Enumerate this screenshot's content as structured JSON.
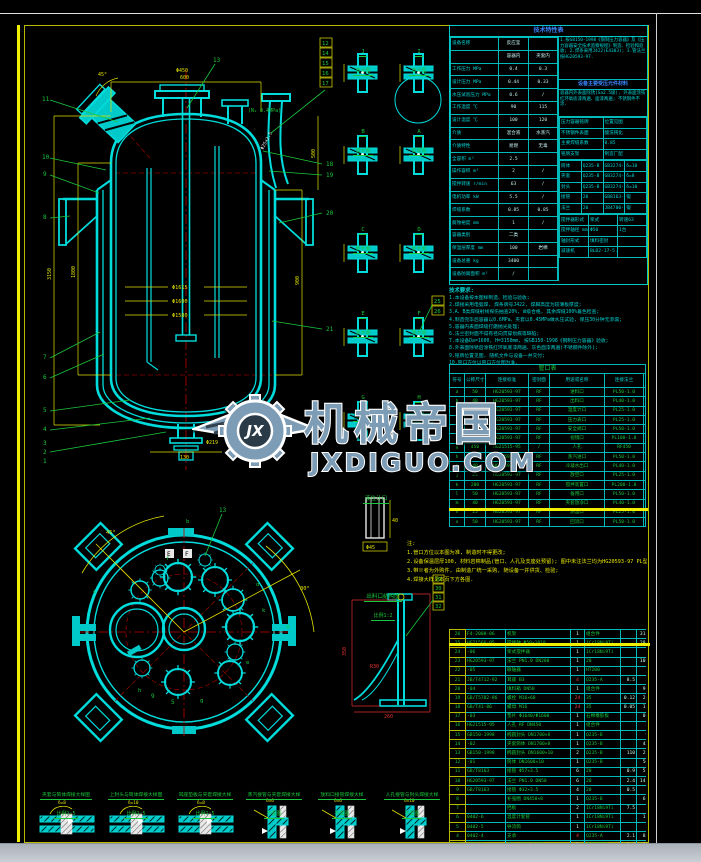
{
  "watermark": {
    "brand": "机械帝国",
    "site": "JXDIGUO.COM",
    "logo_text": "JX"
  },
  "spec_table": {
    "title": "技术特性表",
    "left_rows": [
      [
        "设备名称",
        "反应釜",
        ""
      ],
      [
        "",
        "容器内",
        "夹套内"
      ],
      [
        "工作压力 MPa",
        "0.4",
        "0.3"
      ],
      [
        "设计压力 MPa",
        "0.44",
        "0.33"
      ],
      [
        "水压试验压力 MPa",
        "0.6",
        "/"
      ],
      [
        "工作温度 ℃",
        "90",
        "115"
      ],
      [
        "设计温度 ℃",
        "100",
        "120"
      ],
      [
        "介质",
        "混合液",
        "水蒸汽"
      ],
      [
        "介质特性",
        "易燃",
        "无毒"
      ],
      [
        "全容积 m³",
        "2.5",
        ""
      ],
      [
        "操作容积 m³",
        "2",
        "/"
      ],
      [
        "搅拌转速 r/min",
        "63",
        "/"
      ],
      [
        "电机功率 kW",
        "5.5",
        "/"
      ],
      [
        "焊缝系数",
        "0.85",
        "0.85"
      ],
      [
        "腐蚀裕度 mm",
        "1",
        "/"
      ],
      [
        "容器类别",
        "二类",
        ""
      ],
      [
        "保温层厚度 mm",
        "100",
        "岩棉"
      ],
      [
        "设备总重 kg",
        "3400",
        ""
      ],
      [
        "设备防腐面积 m²",
        "/",
        ""
      ]
    ],
    "right": {
      "standards": "1.按GB150-1998《钢制压力容器》及《压力容器安全技术监察规程》制造、检验和验收; 2.焊条采用J422(E4303); 3.管法兰按HG20593-97.",
      "materials_header": "设备主要受压元件材料",
      "surface": "容器内外表面除锈(Sa2.5级), 外表面涂铁红环氧底漆两遍、面漆两遍; 不锈钢件不涂.",
      "plate_rows": [
        [
          "压力容器铭牌",
          "位置见图"
        ],
        [
          "不锈钢件表面",
          "酸洗钝化"
        ],
        [
          "主要焊缝系数",
          "0.85"
        ],
        [
          "铭牌支架",
          "制造厂配"
        ]
      ],
      "material_rows": [
        [
          "筒体",
          "Q235-B",
          "GB3274-88",
          "δ=10"
        ],
        [
          "夹套",
          "Q235-B",
          "GB3274-88",
          "δ=8"
        ],
        [
          "封头",
          "Q235-B",
          "GB3274-88",
          "δ=10"
        ],
        [
          "接管",
          "20",
          "GB8163-87",
          "锻"
        ],
        [
          "法兰",
          "20",
          "JB4700-92",
          "锻"
        ]
      ],
      "drive_rows": [
        [
          "搅拌器形式",
          "桨式",
          "转速63"
        ],
        [
          "搅拌轴径 mm",
          "Φ50",
          "1台"
        ],
        [
          "轴封形式",
          "填料密封",
          ""
        ],
        [
          "减速机",
          "BLD2-17-5.5",
          ""
        ]
      ]
    }
  },
  "tech_notes": {
    "title": "技术要求:",
    "lines": [
      [
        "1.本设备按本图样制造、检验与验收;"
      ],
      [
        "2.焊接采用电弧焊, 焊条牌号J422, 焊脚高度为较薄板厚度;"
      ],
      [
        "3.A、B类焊缝射线探伤抽查20%, Ⅲ级合格, 其余焊缝100%着色检查;"
      ],
      [
        "4.制造完毕后容器以0.6MPa、夹套以0.45MPa做水压试验, 保压30分钟无渗漏;"
      ],
      [
        "5.容器内表面焊缝打磨抛光处理;"
      ],
      [
        "6.法兰密封面不得有径向贯穿划痕等缺陷;"
      ],
      [
        "7.本设备Da=1600, H=3150mm, 按GB150-1998《钢制压力容器》验收;"
      ],
      [
        "8.外表面除锈后涂铁红环氧底漆两遍、灰色面漆两遍(不锈钢件除外);"
      ],
      [
        "9.铭牌位置见图, 随机文件与设备一并交付;"
      ],
      [
        "10.管口方位以管口方位图为准."
      ]
    ]
  },
  "nozzle_table": {
    "title": "管口表",
    "headers": [
      "符号",
      "公称尺寸",
      "连接标准",
      "密封面",
      "用途或名称",
      "连接法兰",
      "备注"
    ],
    "rows": [
      [
        "a",
        "50",
        "HG20593-97",
        "RF",
        "进料口",
        "PL50-1.0",
        "/"
      ],
      [
        "b",
        "40",
        "HG20593-97",
        "RF",
        "出料口",
        "PL40-1.0",
        ""
      ],
      [
        "c",
        "25",
        "HG20593-97",
        "RF",
        "温度计口",
        "PL25-1.0",
        ""
      ],
      [
        "d",
        "25",
        "HG20593-97",
        "RF",
        "压力表口",
        "PL25-1.0",
        ""
      ],
      [
        "e",
        "50",
        "HG20593-97",
        "RF",
        "安全阀口",
        "PL50-1.0",
        ""
      ],
      [
        "f",
        "100",
        "HG20593-97",
        "RF",
        "视镜口",
        "PL100-1.0",
        ""
      ],
      [
        "g",
        "450",
        "HG21515-95",
        "/",
        "人孔",
        "RF450",
        ""
      ],
      [
        "h",
        "50",
        "HG20593-97",
        "RF",
        "蒸汽进口",
        "PL50-1.0",
        ""
      ],
      [
        "i",
        "40",
        "HG20593-97",
        "RF",
        "冷凝水出口",
        "PL40-1.0",
        ""
      ],
      [
        "j",
        "25",
        "HG20593-97",
        "RF",
        "放空口",
        "PL25-1.0",
        ""
      ],
      [
        "k",
        "200",
        "HG20593-97",
        "RF",
        "搅拌装置口",
        "PL200-1.0",
        ""
      ],
      [
        "l",
        "50",
        "HG20593-97",
        "RF",
        "备用口",
        "PL50-1.0",
        ""
      ],
      [
        "m",
        "40",
        "HG20593-97",
        "RF",
        "夹套放净口",
        "PL40-1.0",
        ""
      ],
      [
        "n",
        "25",
        "HG20593-97",
        "RF",
        "测温口",
        "PL25-1.0",
        ""
      ],
      [
        "o",
        "50",
        "HG20593-97",
        "RF",
        "回流口",
        "PL50-1.0",
        ""
      ]
    ]
  },
  "side_note": {
    "lines": [
      [
        "注:"
      ],
      [
        "1.管口方位以本图为准, 制造时不得更改;"
      ],
      [
        "2.设备保温层厚100, 材料岩棉制品(管口、人孔及支座处预留); 图中未注法兰均为HG20593-97 PL型平焊法兰(RF);"
      ],
      [
        "3.带※者为外购件, 由制造厂统一采购, 随设备一并供货、检验;"
      ],
      [
        "4.焊接大样见本页下方各图."
      ]
    ]
  },
  "parts_table": {
    "rows": [
      {
        "cells": [
          "26",
          "F4-2008-06",
          "机架",
          "1",
          "组合件",
          "",
          "31.5",
          ""
        ]
      },
      {
        "cells": [
          "25",
          "HG21566-95",
          "搅拌轴 Φ50×1810",
          "1",
          "1Cr18Ni9Ti",
          "",
          "28.5",
          ""
        ]
      },
      {
        "cells": [
          "24",
          "-06",
          "桨式搅拌器",
          "1",
          "1Cr18Ni9Ti",
          "",
          "12",
          ""
        ]
      },
      {
        "cells": [
          "23",
          "HG20593-97",
          "法兰 PN1.0 DN200",
          "1",
          "20",
          "",
          "10.3",
          ""
        ]
      },
      {
        "cells": [
          "22",
          "-05",
          "联轴器",
          "1",
          "HT200",
          "",
          "15",
          ""
        ]
      },
      {
        "cells": [
          "21",
          "JB/T4712-92",
          "耳座 B3",
          "4",
          "Q235-A",
          "8.5",
          "34",
          ""
        ],
        "cls": "red"
      },
      {
        "cells": [
          "20",
          "-04",
          "填料箱 DN50",
          "1",
          "组合件",
          "",
          "9.6",
          ""
        ]
      },
      {
        "cells": [
          "19",
          "GB/T5782-86",
          "螺栓 M16×60",
          "24",
          "35",
          "0.12",
          "2.9",
          ""
        ],
        "cls": "red"
      },
      {
        "cells": [
          "18",
          "GB/T41-86",
          "螺母 M16",
          "24",
          "35",
          "0.05",
          "1.2",
          ""
        ],
        "cls": "red"
      },
      {
        "cells": [
          "17",
          "-03",
          "垫片 Φ1640/Φ1600",
          "1",
          "石棉橡胶板",
          "",
          "0.8",
          ""
        ]
      },
      {
        "cells": [
          "16",
          "HG21515-95",
          "人孔 RF DN450",
          "1",
          "组合件",
          "",
          "51",
          "带盖"
        ]
      },
      {
        "cells": [
          "15",
          "GB150-1998",
          "椭圆封头 DN1700×8",
          "1",
          "Q235-B",
          "",
          "95",
          ""
        ]
      },
      {
        "cells": [
          "14",
          "-02",
          "夹套筒体 DN1700×8",
          "1",
          "Q235-B",
          "",
          "420",
          ""
        ]
      },
      {
        "cells": [
          "13",
          "GB150-1998",
          "椭圆封头 DN1600×10",
          "2",
          "Q235-B",
          "110",
          "220",
          ""
        ]
      },
      {
        "cells": [
          "12",
          "-01",
          "筒体 DN1600×10",
          "1",
          "Q235-B",
          "",
          "560",
          ""
        ]
      },
      {
        "cells": [
          "11",
          "GB/T8163",
          "接管 Φ57×3.5",
          "6",
          "20",
          "0.9",
          "5.4",
          ""
        ]
      },
      {
        "cells": [
          "10",
          "HG20593-97",
          "法兰 PN1.0 DN50",
          "6",
          "20",
          "2.4",
          "14.4",
          ""
        ]
      },
      {
        "cells": [
          "9",
          "GB/T8163",
          "接管 Φ32×3.5",
          "4",
          "20",
          "0.5",
          "2",
          ""
        ]
      },
      {
        "cells": [
          "8",
          "",
          "补强圈 DN450×8",
          "1",
          "Q235-B",
          "",
          "6.5",
          ""
        ]
      },
      {
        "cells": [
          "7",
          "",
          "挡板",
          "2",
          "1Cr18Ni9Ti",
          "7.5",
          "15",
          ""
        ]
      },
      {
        "cells": [
          "6",
          "0402-6",
          "温度计套管",
          "1",
          "1Cr18Ni9Ti",
          "",
          "1.8",
          ""
        ]
      },
      {
        "cells": [
          "5",
          "0402-5",
          "导流筒",
          "1",
          "1Cr18Ni9Ti",
          "",
          "22",
          ""
        ]
      },
      {
        "cells": [
          "4",
          "0402-4",
          "支承",
          "4",
          "Q235-A",
          "2.1",
          "8.4",
          ""
        ],
        "cls": "red"
      },
      {
        "cells": [
          "3",
          "0402-3",
          "垫片 Φ505/Φ450",
          "2",
          "石棉橡胶板",
          "0.4",
          "0.8",
          ""
        ]
      },
      {
        "cells": [
          "2",
          "0402-2",
          "视镜 HGJ501-86",
          "1",
          "组合件",
          "",
          "6.8",
          ""
        ]
      },
      {
        "cells": [
          "1",
          "0402-1",
          "放料阀 DN40",
          "1",
          "1Cr18Ni9Ti",
          "",
          "9.5",
          ""
        ]
      }
    ]
  },
  "details_mid": {
    "titles": [
      {
        "letter": "J",
        "sub": "放大图"
      },
      {
        "letter": "I",
        "sub": "放大图"
      },
      {
        "letter": "B",
        "sub": "放大图"
      },
      {
        "letter": "A",
        "sub": "向视图"
      },
      {
        "letter": "C",
        "sub": "放大图"
      },
      {
        "letter": "D",
        "sub": "放大图"
      },
      {
        "letter": "E",
        "sub": "放大图"
      },
      {
        "letter": "F",
        "sub": "放大图"
      },
      {
        "letter": "G",
        "sub": "放大图"
      },
      {
        "letter": "H",
        "sub": "放大图"
      }
    ],
    "balloons": [
      "25",
      "26"
    ]
  },
  "details_bottom": {
    "items": [
      {
        "t": "夹套与筒体焊接大样图",
        "s": "比例1:5",
        "dim": "δ=8"
      },
      {
        "t": "上封头与筒体焊接大样图",
        "s": "比例1:5",
        "dim": "δ=10"
      },
      {
        "t": "耳座垫板与夹套焊接大样",
        "s": "比例1:5",
        "dim": "δ=8"
      },
      {
        "t": "蒸汽接管与夹套焊接大样",
        "s": "不需图",
        "dim": "δ=6"
      },
      {
        "t": "放料口接管焊接大样",
        "s": "不需图",
        "dim": "δ=6"
      },
      {
        "t": "人孔接管与封头焊接大样",
        "s": "不需图",
        "dim": "δ=10"
      }
    ]
  },
  "elev": {
    "balloons_left": [
      "11",
      "10",
      "9",
      "8",
      "7",
      "6",
      "5",
      "4",
      "3",
      "2",
      "1"
    ],
    "boxed": [
      "12",
      "14",
      "15",
      "16",
      "17"
    ],
    "balloons_right": [
      "18",
      "19",
      "20",
      "21"
    ],
    "balloon_top": "13",
    "dims": [
      "3150",
      "1800",
      "600",
      "Φ450",
      "Φ1615",
      "Φ1600",
      "Φ1580",
      "900",
      "500",
      "Φ219",
      "45°",
      "130"
    ],
    "note": "(N₂ 0.4MPa)",
    "pipe_label": "Φ25×2.5"
  },
  "plan": {
    "balloon": "13",
    "balloon5": "5",
    "balloon9": "9",
    "letters": [
      "a",
      "b",
      "c",
      "d",
      "e",
      "f",
      "g",
      "h",
      "k"
    ],
    "angles": [
      "45°",
      "30°"
    ],
    "sections": [
      "E",
      "F"
    ]
  },
  "bracket_detail": {
    "title": "出料口结构图",
    "subtitle": "比例1:2",
    "balloons": [
      "29",
      "30",
      "31",
      "32"
    ],
    "dims": [
      "350",
      "260",
      "R30"
    ]
  },
  "small_detail": {
    "title": "液位计口",
    "dims": [
      "40",
      "Φ45"
    ]
  }
}
